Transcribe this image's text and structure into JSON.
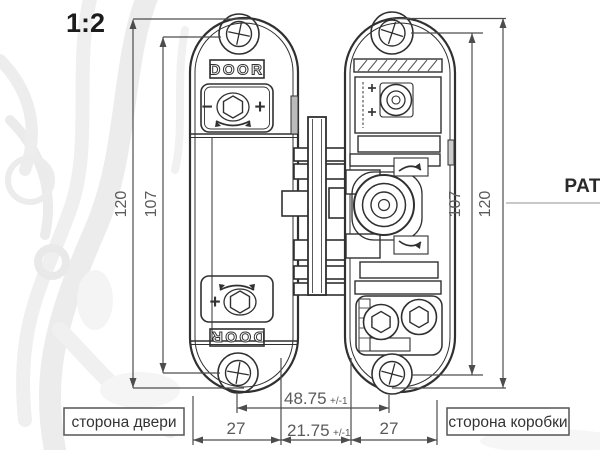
{
  "colors": {
    "background": "#ffffff",
    "drawing_line": "#303030",
    "dimension_line": "#4d4d4d",
    "dimension_text": "#5a5a5a",
    "label_text": "#333333",
    "watermark": "#dedede",
    "pat_leader_line": "#c8c8c8"
  },
  "header": {
    "scale_label": "1:2",
    "patent_label": "PAT"
  },
  "hinges": {
    "left": {
      "name": "door-side hinge body",
      "marking_top": "DOOR",
      "marking_bottom": "DOOR",
      "adjust_minus": "−",
      "adjust_plus_top": "+",
      "adjust_plus_bottom": "+"
    },
    "right": {
      "name": "frame-side hinge body"
    }
  },
  "dimensions": {
    "left_outer": {
      "value": "120"
    },
    "left_inner": {
      "value": "107"
    },
    "right_inner": {
      "value": "107"
    },
    "right_outer": {
      "value": "120"
    },
    "screw_spacing": {
      "value": "48.75",
      "tolerance": "+/-1"
    },
    "bottom_left": {
      "value": "27"
    },
    "bottom_middle": {
      "value": "21.75",
      "tolerance": "+/-1"
    },
    "bottom_right": {
      "value": "27"
    }
  },
  "footer_labels": {
    "door_side": "сторона двери",
    "frame_side": "сторона коробки"
  }
}
